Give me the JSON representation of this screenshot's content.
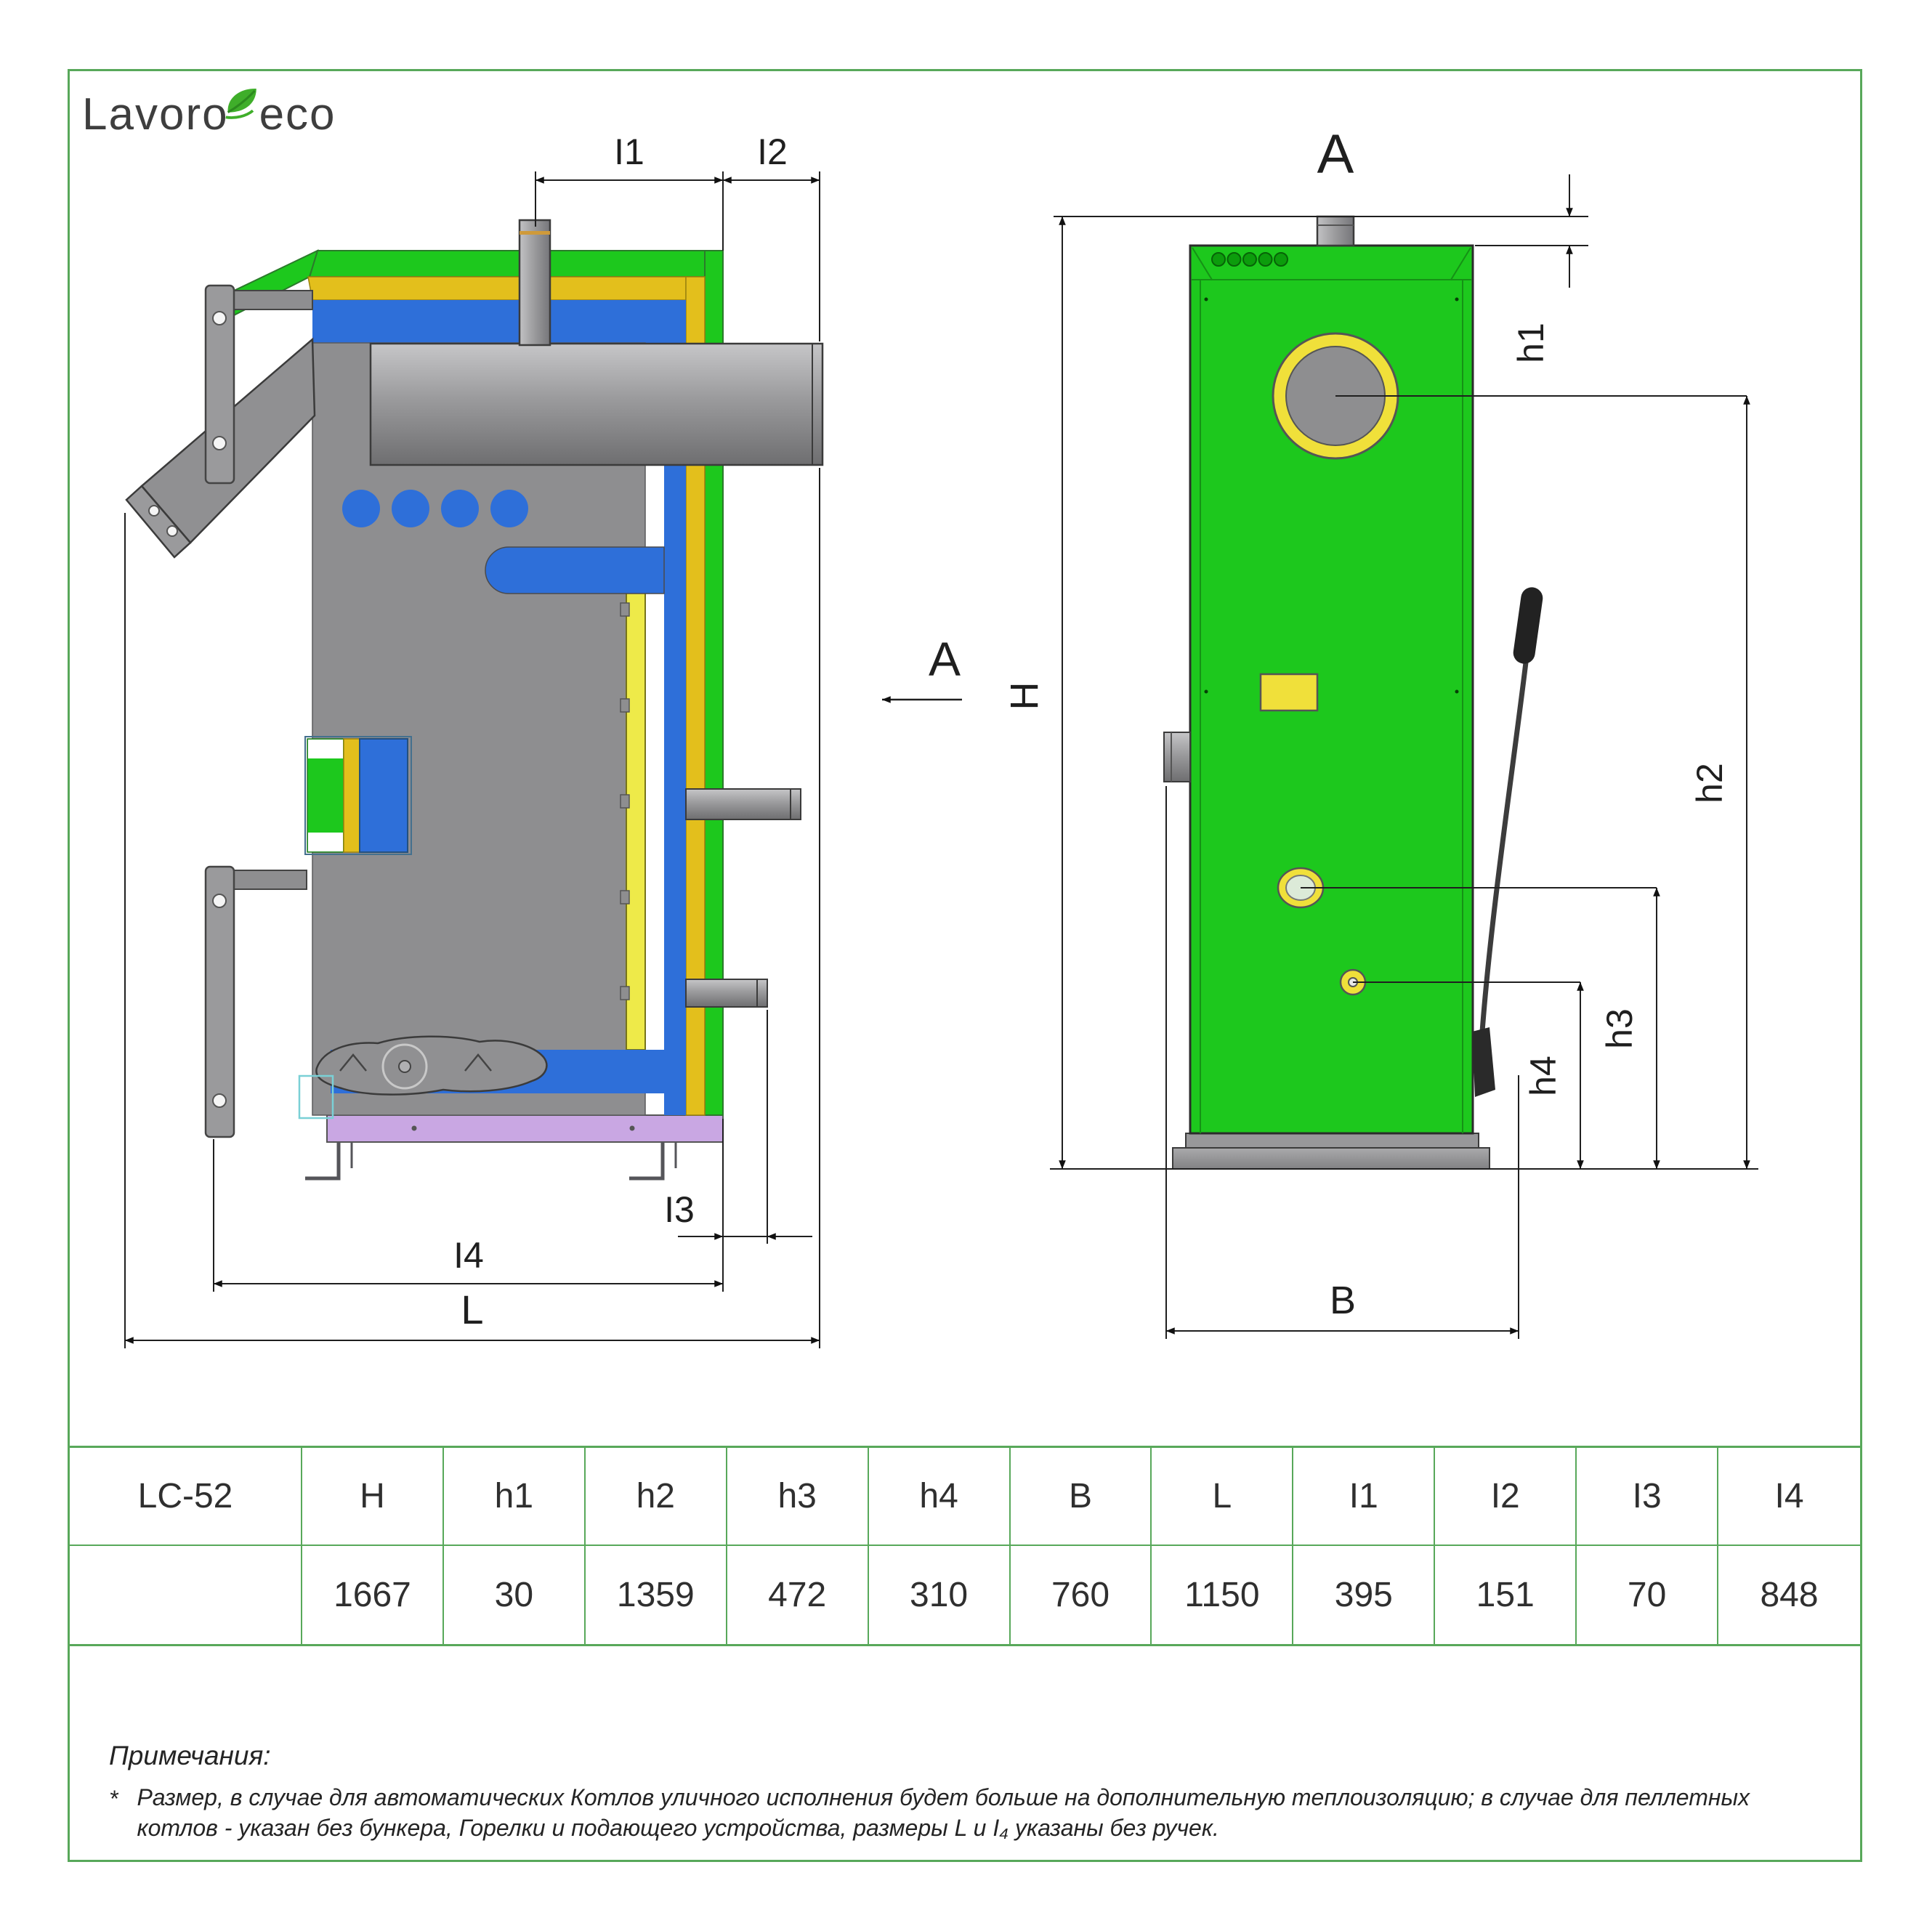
{
  "logo": {
    "part1": "Lavoro",
    "part2": "eco",
    "leaf_color": "#3fae2a",
    "text_color": "#3e3e3e"
  },
  "view_side": {
    "name": "side section view of boiler",
    "dim_labels": {
      "I1": "I1",
      "I2": "I2",
      "I3": "I3",
      "I4": "I4",
      "L": "L"
    }
  },
  "view_front": {
    "title": "A",
    "view_arrow_label": "A",
    "dim_labels": {
      "H": "H",
      "h1": "h1",
      "h2": "h2",
      "h3": "h3",
      "h4": "h4",
      "B": "B"
    }
  },
  "table": {
    "model": "LC-52",
    "headers": [
      "LC-52",
      "H",
      "h1",
      "h2",
      "h3",
      "h4",
      "B",
      "L",
      "I1",
      "I2",
      "I3",
      "I4"
    ],
    "values": [
      "",
      "1667",
      "30",
      "1359",
      "472",
      "310",
      "760",
      "1150",
      "395",
      "151",
      "70",
      "848"
    ]
  },
  "notes": {
    "title": "Примечания:",
    "marker": "*",
    "text": "Размер, в случае для автоматических Котлов уличного исполнения будет больше на дополнительную теплоизоляцию; в случае для пеллетных котлов - указан без бункера, Горелки и подающего устройства, размеры L и I₄ указаны без ручек."
  },
  "colors": {
    "casing_green": "#1dc81d",
    "insulation_yellow": "#e3bf1c",
    "water_blue": "#2e6fd9",
    "metal_gray": "#8e8e90",
    "base_purple": "#c9a7e3",
    "exchanger_light_yellow": "#eeea49",
    "frame_green": "#58a85a",
    "sight_glass": "#dcead8",
    "handle_black": "#222222"
  }
}
